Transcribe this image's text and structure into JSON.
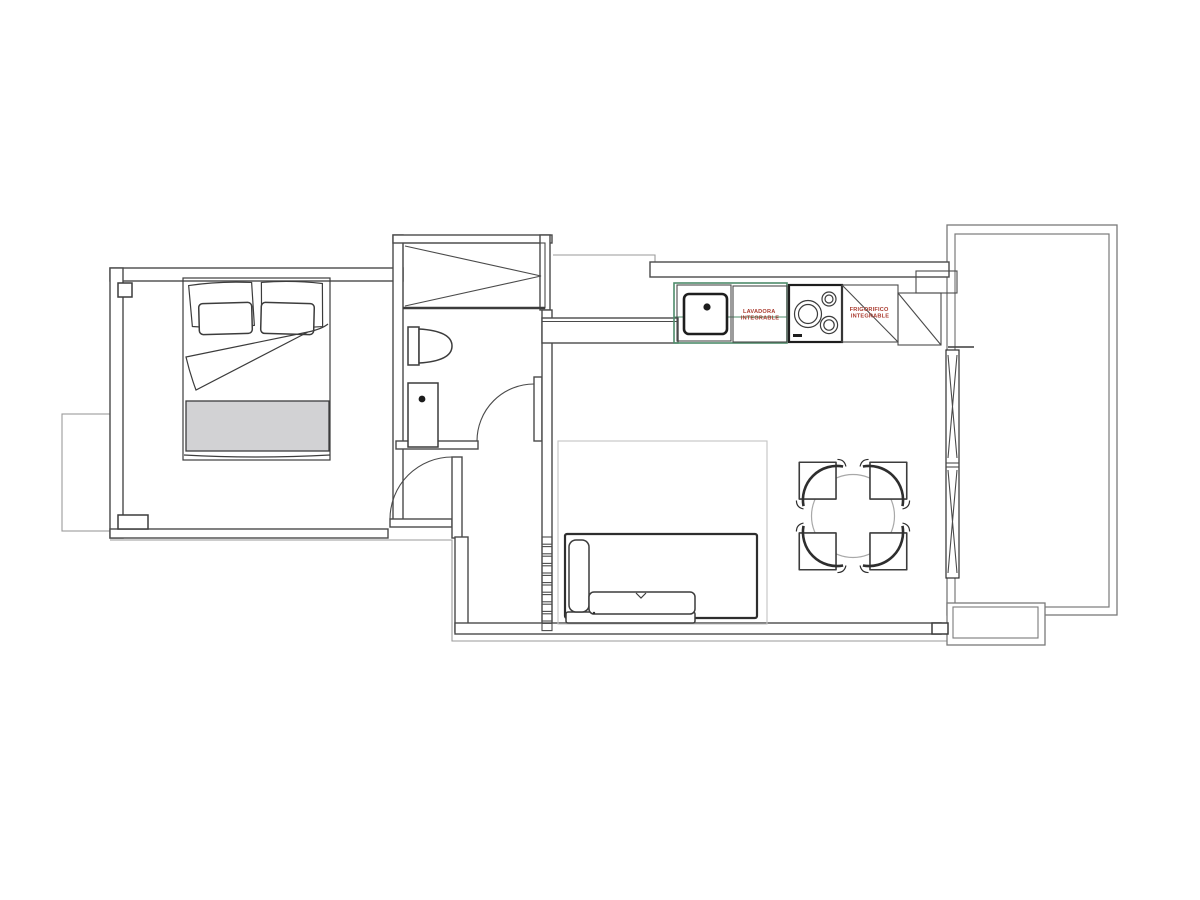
{
  "title": "apartment-floor-plan",
  "kitchen": {
    "washer": {
      "line1": "LAVADORA",
      "line2": "INTEGRABLE"
    },
    "fridge": {
      "line1": "FRIGORIFICO",
      "line2": "INTEGRABLE"
    }
  },
  "colors": {
    "label_red": "#a93a2e",
    "counter_green": "#4e8c6a",
    "wall_dark": "#4a4a4a",
    "outline_gray": "#9a9a9a",
    "rug_gray": "#c4c4c4",
    "blanket_gray": "#d2d2d4"
  }
}
